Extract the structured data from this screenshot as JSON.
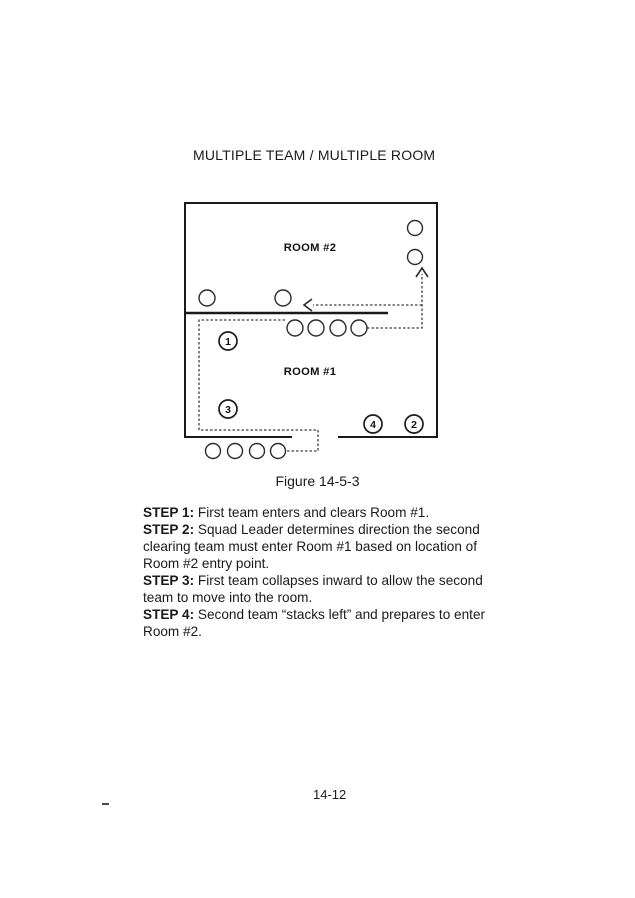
{
  "page": {
    "title": "MULTIPLE TEAM / MULTIPLE ROOM",
    "figure_caption": "Figure 14-5-3",
    "page_number": "14-12",
    "stray_mark": "-"
  },
  "diagram": {
    "room2_label": "ROOM #2",
    "room1_label": "ROOM #1",
    "markers": [
      {
        "number": "1"
      },
      {
        "number": "3"
      },
      {
        "number": "4"
      },
      {
        "number": "2"
      }
    ]
  },
  "steps": [
    {
      "label": "STEP 1:",
      "text": "First team enters and clears Room #1."
    },
    {
      "label": "STEP 2:",
      "text": "Squad Leader determines direction the second clearing team must enter Room #1 based on location of Room #2 entry point."
    },
    {
      "label": "STEP 3:",
      "text": "First team collapses inward to allow the second team to move into the room."
    },
    {
      "label": "STEP 4:",
      "text": "Second team “stacks left” and prepares to enter Room #2."
    }
  ],
  "colors": {
    "ink": "#1a1a1a",
    "dashed_line": "#3f3f3f",
    "background": "#ffffff"
  }
}
